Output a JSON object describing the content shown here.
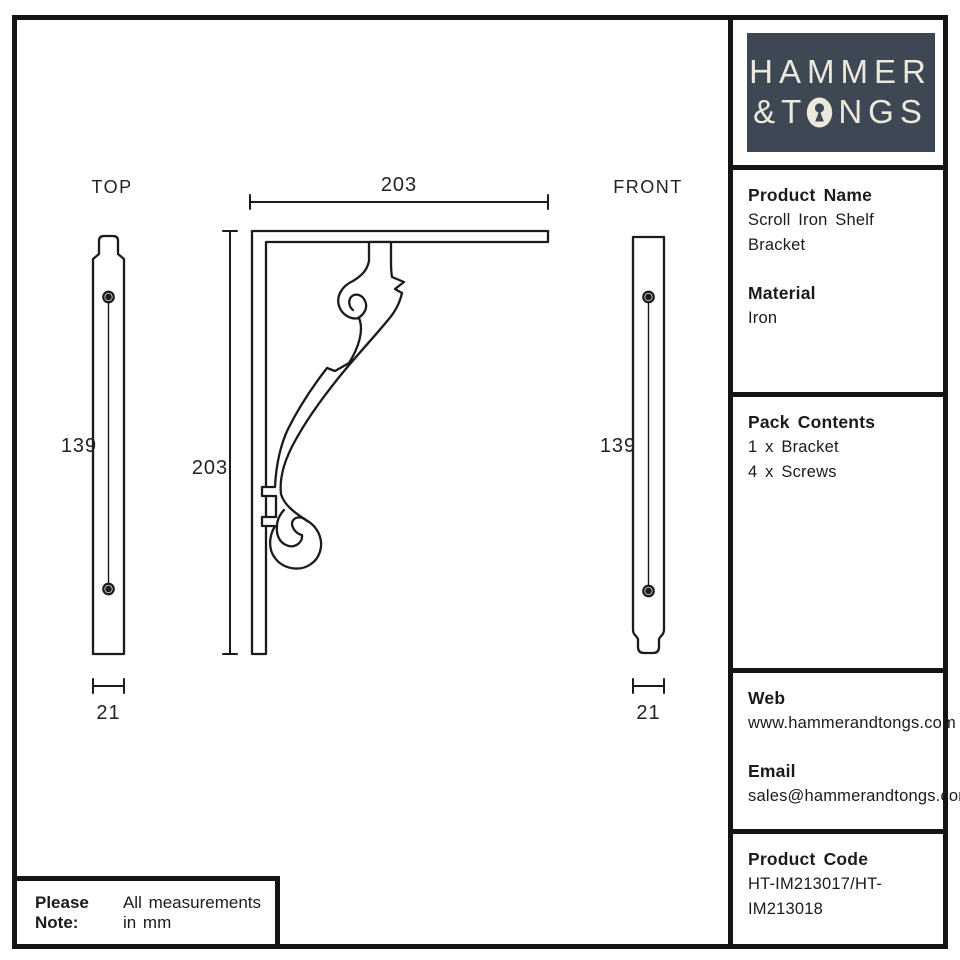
{
  "brand": {
    "line1": "HAMMER",
    "line2_start": "&T",
    "line2_end": "NGS"
  },
  "sidebar": {
    "product_name_label": "Product Name",
    "product_name_value": "Scroll Iron Shelf Bracket",
    "material_label": "Material",
    "material_value": "Iron",
    "pack_contents_label": "Pack Contents",
    "pack_items": [
      "1 x Bracket",
      "4 x Screws"
    ],
    "web_label": "Web",
    "web_value": "www.hammerandtongs.com",
    "email_label": "Email",
    "email_value": "sales@hammerandtongs.com",
    "product_code_label": "Product Code",
    "product_code_value": "HT-IM213017/HT-IM213018"
  },
  "note": {
    "label": "Please Note:",
    "text": "All measurements in mm"
  },
  "drawing": {
    "top_view": {
      "label": "TOP",
      "height": "139",
      "width": "21"
    },
    "front_view": {
      "label": "FRONT",
      "height": "139",
      "width": "21"
    },
    "bracket": {
      "width": "203",
      "height": "203"
    }
  },
  "colors": {
    "line": "#1b1b1b",
    "logo_bg": "#3e4754",
    "logo_text": "#ece9dc"
  }
}
